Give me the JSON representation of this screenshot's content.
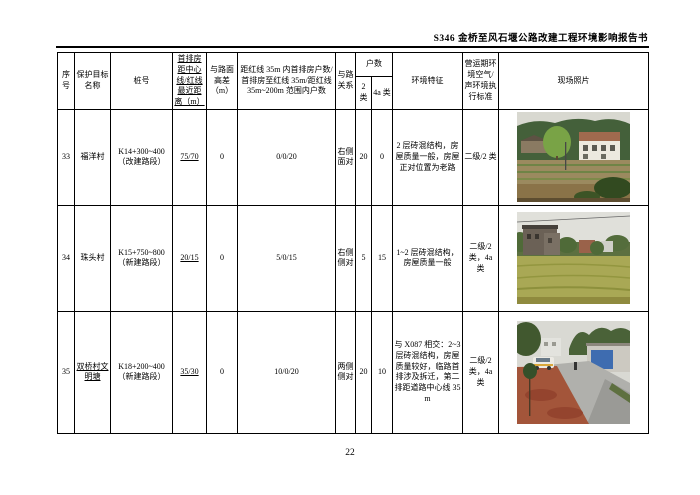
{
  "page": {
    "header_title": "S346 金桥至风石堰公路改建工程环境影响报告书",
    "page_number": "22"
  },
  "table": {
    "headers": {
      "seq": "序号",
      "name": "保护目标名称",
      "stake": "桩号",
      "first_row_distance": "首排房距中心线/红线最近距离（m）",
      "height_diff": "与路面高差（m）",
      "households_range": "距红线 35m 内首排房户数/首排房至红线 35m/距红线 35m~200m 范围内户数",
      "road_relation": "与路关系",
      "households": "户数",
      "class2": "2 类",
      "class4a": "4a 类",
      "env_features": "环境特征",
      "standard": "营运期环境空气/声环境执行标准",
      "photo": "现场照片"
    },
    "rows": [
      {
        "seq": "33",
        "name": "福洋村",
        "stake": "K14+300~400（改建路段）",
        "first_row_distance": "75/70",
        "height_diff": "0",
        "households_range": "0/0/20",
        "road_relation": "右侧面对",
        "class2": "20",
        "class4a": "0",
        "env_features": "2 层砖混结构，房屋质量一般，房屋正对位置为老路",
        "standard": "二级/2 类"
      },
      {
        "seq": "34",
        "name": "珠头村",
        "stake": "K15+750~800（新建路段）",
        "first_row_distance": "20/15",
        "height_diff": "0",
        "households_range": "5/0/15",
        "road_relation": "右侧侧对",
        "class2": "5",
        "class4a": "15",
        "env_features": "1~2 层砖混结构，房屋质量一般",
        "standard": "二级/2 类，4a 类"
      },
      {
        "seq": "35",
        "name": "双桥村文明塘",
        "stake": "K18+200~400（新建路段）",
        "first_row_distance": "35/30",
        "height_diff": "0",
        "households_range": "10/0/20",
        "road_relation": "两侧侧对",
        "class2": "20",
        "class4a": "10",
        "env_features": "与 X087 相交：2~3 层砖混结构，房屋质量较好，临路首排涉及拆迁，第二排距道路中心线 35m",
        "standard": "二级/2 类，4a 类"
      }
    ]
  },
  "photos": {
    "p33": {
      "desc": "山坡林地前的两三层砖房与农田",
      "sky": "#d8d8d0",
      "hill": "#44603a",
      "tree": "#79a346",
      "building_wall": "#ece9df",
      "building_top": "#a06a4e",
      "field": "#9b8a5f",
      "soil": "#8a7348"
    },
    "p34": {
      "desc": "稻田后方的村庄砖房与树木",
      "sky": "#e0e0da",
      "trees": "#5c7040",
      "building": "#6b6156",
      "red_building": "#9a624a",
      "field": "#a9a855"
    },
    "p35": {
      "desc": "红土路肩旁的乡村公路、白车与蓝色墙面房屋",
      "sky": "#d9d9d3",
      "trees": "#4a6238",
      "road": "#b0b0ac",
      "dirt": "#a3553a",
      "sign_blue": "#3e6cb0",
      "car": "#eceae4"
    }
  },
  "colors": {
    "table_border": "#000000",
    "text": "#000000"
  }
}
